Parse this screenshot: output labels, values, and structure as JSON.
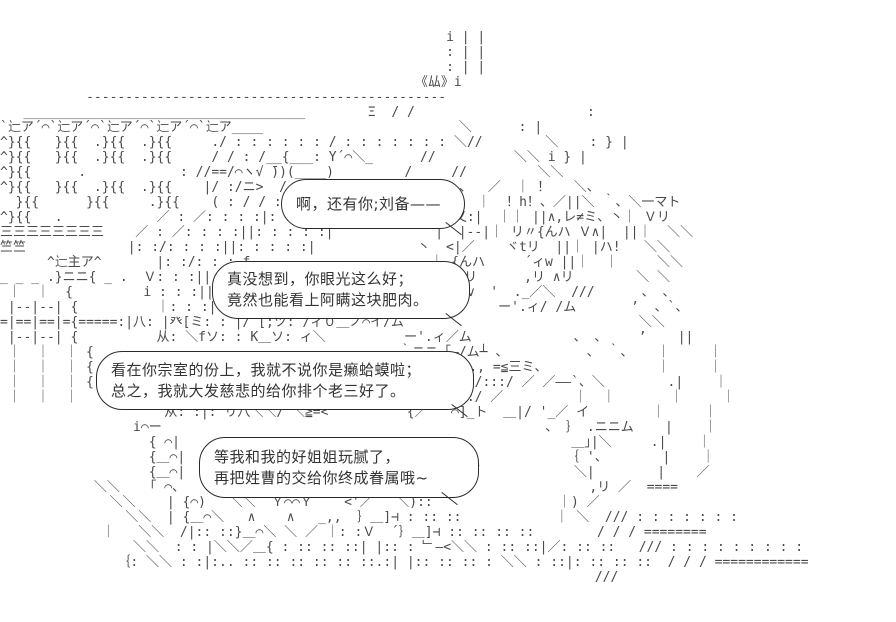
{
  "colors": {
    "background": "#ffffff",
    "ink": "#4a4a4a",
    "bubble_border": "#2a2a2a",
    "text": "#333333"
  },
  "dialogue": {
    "bubble1": {
      "line1": "啊，还有你;刘备——"
    },
    "bubble2": {
      "line1": "真没想到，你眼光这么好；",
      "line2": "竟然也能看上阿瞒这块肥肉。"
    },
    "bubble3": {
      "line1": "看在你宗室的份上，我就不说你是癞蛤蟆啦；",
      "line2": "总之，我就大发慈悲的给你排个老三好了。"
    },
    "bubble4": {
      "line1": "等我和我的好姐姐玩腻了，",
      "line2": "再把姓曹的交给你终成眷属哦~"
    }
  },
  "ascii_art": {
    "lines": [
      "",
      "",
      "                                                         i | |",
      "                                                         : | |",
      "                                                         : | |",
      "                                                     《厸》i",
      "           ----------------------------------------------",
      "   ____________________________________        Ξ  / /                      :",
      "`辷ア´⌒`辷ア´⌒`辷ア´⌒`辷ア´⌒`辷ア____                         ＼      : |",
      "^}{{   }{{  .}{{  .}{{     ./ : : : : : : / : : : : : : : ＼//        ＼    : } |",
      "^}{{   }{{  .}{{  .}{{     / / : /__{___: Y´⌒＼_      //          ＼＼ i } |",
      "^}{{      .            : //==/⌒ヽ√ ̄))(____)         /     //         ＼＼",
      "^}{{   }{{  .}{{  .}{{    |/ :/ニ>  / ::f                  、  ／  ｜ ！   ＼、",
      "  }{{      }{{     .}{{    ( : / / : / : : : :|              ｜  ！h！、／||＼ ｀、＼一マト",
      "^}{{   .            ／ : ／: : : :|: : : : 丶              乂:|  ｜｜ ||∧,レ≠ミ、丶｜ Ｖリ",
      "三三三三三三三三    ／ : ／: : : :||: : : : :|             |  |--|｜ リ〃{んハ Ｖ∧|  ||｜  ＼＼",
      "竺竺             |: :/: : : :||: : : : :|             丶  <|／    ヾtリ  ||｜ |ハ!   ＼＼",
      "      ^辷主ア^       |: :/: : : f                       ｜ {んハ     ´ィw ||｜  ｜     ＼＼",
      "_ _ _ .}ニニ{ _ .  Ｖ: : :||                           ｜ ヾtリ      ,リ ∧リ        ＼ ＼",
      " ｜  ｜  {         i : : :||                           ㄑ  ィv  '  ._／＼  ///      、 、",
      " |--|--| {          ｜: : :|丶                          ＼ 、    ー'.ィ/ /ム       ’  、`、",
      "=|==|==|={=====:|八: |癶[ミ: : |/ [;ツ: /ィ０＿ノ⌒イ/ム                              ＼＼",
      " |--|--| {          从: ＼fソ: : K＿ソ: ィ＼          ー'.ィ／ム             、 、    ’    ||",
      " ｜  ｜  ｜ {                                       ｀ニニ「―/ム┴ 、          、 ｀、   ｜     ｜",
      " ｜  ｜  ｜ {                                        ｜ ／〃  ., =≦三ミ、              ｜     ｜",
      " ｜  ｜  ｜ {                                       ｜/| ||  ./:::/ ／ ／――`、＼        .|    ｜",
      " ｜  ｜  ｜                                        乂/| ||  /:/ ／         ｜  ｜       ｜     ｜",
      "                     从: :|: リ八＼＼/ ＼≧=<          {／   ⌒]_ト  ＿|/ '_／ イ        ｜     ｜",
      "                 i⌒ー                                                 、 ｝ .ニニム    |    ｜",
      "                   { ⌒|                                                  ＿｣|＼     .|    ｜",
      "                   {＿⌒|                                 ｝              ｛ '、       |    ｜",
      "                   {＿⌒|                                 /:|／            ＼|        |    ／",
      "            ＼＼   「 ⌒、                             乂: :|                 ,リ ／  ====",
      "              ＼＼    | {⌒)   ＼＼  Ｙ⌒⌒Ｙ    <'／   ＼)::                ｜) ／",
      "                ＼＼  | {＿⌒＼   ∧    ∧   _,,  ｝＿]⊣ : :: ::            ｜ ＼  /// : : : : : : :",
      "             ｜   ＼＼  /|:: ::}＿⌒＼ ＼ ／ ｜: :Ｖ  ´｝＿]⊣ :: :: :: ::        / / / ========",
      "                 ＼＼  : : |＼＼／＿{ : :: :: ::| |:: : ﹂—<＼＼ : :: ::|／: :: ::   /// : : : : : : : : :",
      "               ｛: ＼＼ : :|:.. :: :: :: :: :: ::.:| |:: :: :: : ＼＼ : ::|: :: :: ::  / / / ============",
      "                                                                            ///",
      "",
      ""
    ]
  }
}
